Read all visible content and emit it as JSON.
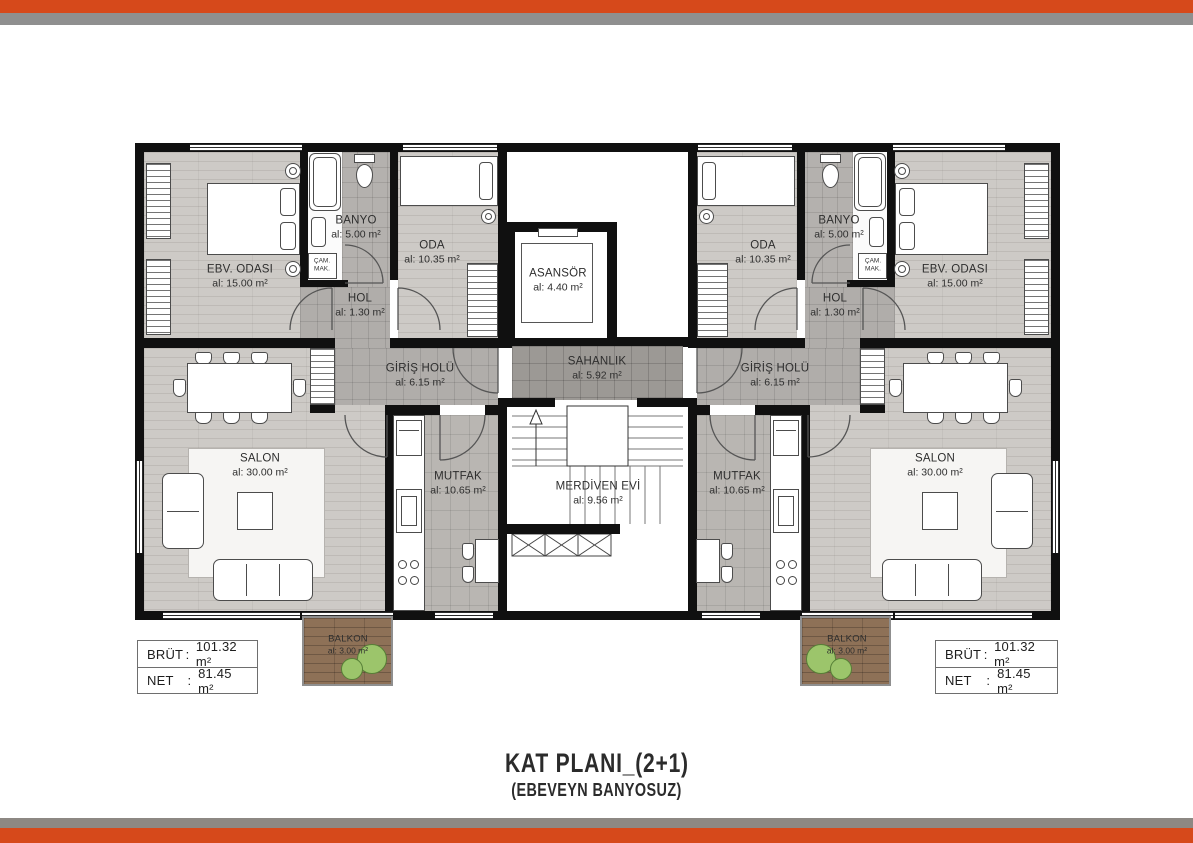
{
  "colors": {
    "orange": "#d6491b",
    "gray_top": "#8f8f8f",
    "gray_bottom": "#8d8883"
  },
  "title": {
    "line1": "KAT PLANI_(2+1)",
    "line2": "(EBEVEYN BANYOSUZ)"
  },
  "info_boxes": [
    {
      "rows": [
        {
          "label": "BRÜT",
          "sep": ":",
          "value": "101.32 m²"
        },
        {
          "label": "NET",
          "sep": ":",
          "value": "81.45 m²"
        }
      ]
    },
    {
      "rows": [
        {
          "label": "BRÜT",
          "sep": ":",
          "value": "101.32 m²"
        },
        {
          "label": "NET",
          "sep": ":",
          "value": "81.45 m²"
        }
      ]
    }
  ],
  "rooms": [
    {
      "id": "ebv-odasi-left",
      "name": "EBV. ODASI",
      "area": "al: 15.00 m²",
      "x": 240,
      "y": 277
    },
    {
      "id": "banyo-left",
      "name": "BANYO",
      "area": "al: 5.00 m²",
      "x": 356,
      "y": 228
    },
    {
      "id": "oda-left",
      "name": "ODA",
      "area": "al: 10.35 m²",
      "x": 432,
      "y": 253
    },
    {
      "id": "hol-left",
      "name": "HOL",
      "area": "al: 1.30 m²",
      "x": 360,
      "y": 306
    },
    {
      "id": "giris-holu-left",
      "name": "GİRİŞ HOLÜ",
      "area": "al: 6.15 m²",
      "x": 420,
      "y": 376
    },
    {
      "id": "salon-left",
      "name": "SALON",
      "area": "al: 30.00 m²",
      "x": 260,
      "y": 466
    },
    {
      "id": "mutfak-left",
      "name": "MUTFAK",
      "area": "al: 10.65 m²",
      "x": 458,
      "y": 484
    },
    {
      "id": "balkon-left",
      "name": "BALKON",
      "area": "al: 3.00 m²",
      "x": 348,
      "y": 645,
      "small": true
    },
    {
      "id": "asansor",
      "name": "ASANSÖR",
      "area": "al: 4.40 m²",
      "x": 558,
      "y": 281
    },
    {
      "id": "sahanlik",
      "name": "SAHANLIK",
      "area": "al: 5.92 m²",
      "x": 597,
      "y": 369
    },
    {
      "id": "merdiven-evi",
      "name": "MERDİVEN EVİ",
      "area": "al: 9.56 m²",
      "x": 598,
      "y": 494
    },
    {
      "id": "oda-right",
      "name": "ODA",
      "area": "al: 10.35 m²",
      "x": 763,
      "y": 253
    },
    {
      "id": "banyo-right",
      "name": "BANYO",
      "area": "al: 5.00 m²",
      "x": 839,
      "y": 228
    },
    {
      "id": "ebv-odasi-right",
      "name": "EBV. ODASI",
      "area": "al: 15.00 m²",
      "x": 955,
      "y": 277
    },
    {
      "id": "hol-right",
      "name": "HOL",
      "area": "al: 1.30 m²",
      "x": 835,
      "y": 306
    },
    {
      "id": "giris-holu-right",
      "name": "GİRİŞ HOLÜ",
      "area": "al: 6.15 m²",
      "x": 775,
      "y": 376
    },
    {
      "id": "mutfak-right",
      "name": "MUTFAK",
      "area": "al: 10.65 m²",
      "x": 737,
      "y": 484
    },
    {
      "id": "salon-right",
      "name": "SALON",
      "area": "al: 30.00 m²",
      "x": 935,
      "y": 466
    },
    {
      "id": "balkon-right",
      "name": "BALKON",
      "area": "al: 3.00 m²",
      "x": 847,
      "y": 645,
      "small": true
    }
  ],
  "fixtures": [
    {
      "id": "cam-mak-left",
      "lines": [
        "ÇAM.",
        "MAK."
      ],
      "x": 322,
      "y": 266
    },
    {
      "id": "cam-mak-right",
      "lines": [
        "ÇAM.",
        "MAK."
      ],
      "x": 873,
      "y": 266
    }
  ]
}
